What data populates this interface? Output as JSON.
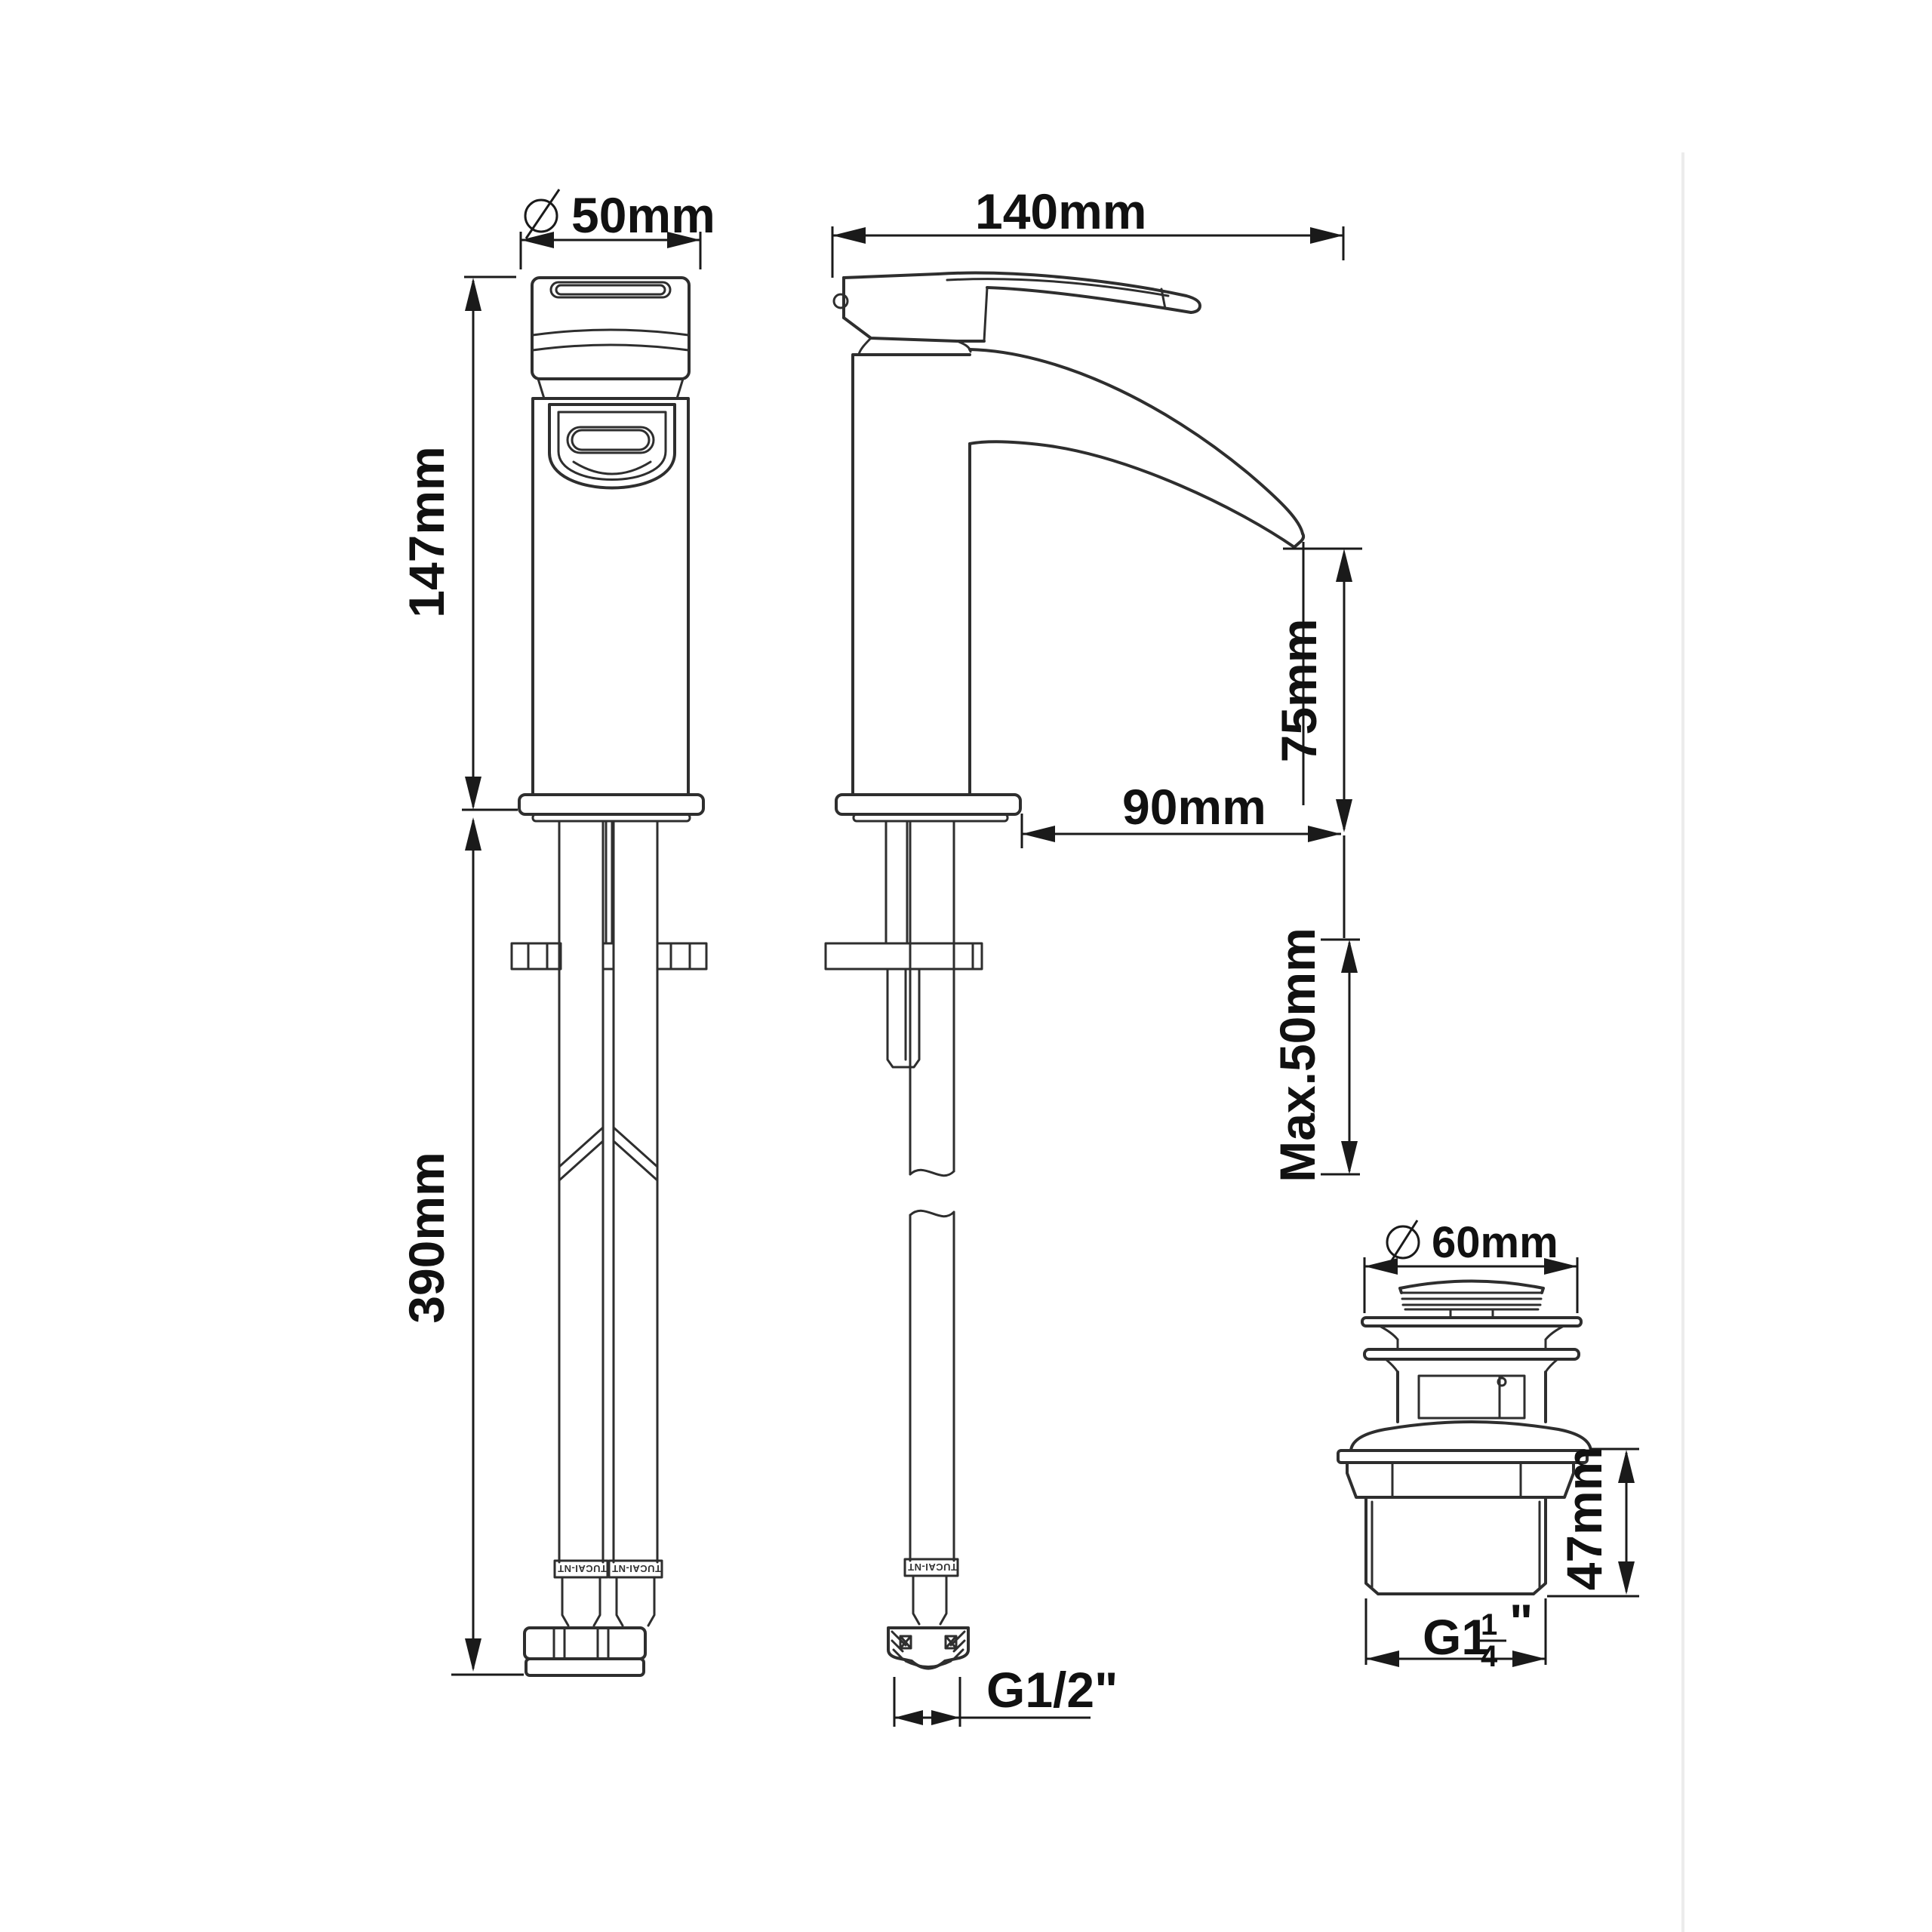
{
  "page": {
    "background": "#ffffff"
  },
  "drawing": {
    "line_color": "#2e2e2e",
    "text_color": "#111111",
    "divider_color": "#ececec"
  },
  "front_view": {
    "diameter_label": "50mm",
    "height_label": "147mm",
    "hose_length_label": "390mm",
    "hose_brand": "TUCAI-NT"
  },
  "side_view": {
    "length_label": "140mm",
    "spout_height_label": "75mm",
    "spout_reach_label": "90mm",
    "max_deck_label": "Max.50mm",
    "hose_thread_label": "G1/2\"",
    "hose_brand": "TUCAI-NT"
  },
  "waste_view": {
    "diameter_label": "60mm",
    "height_label": "47mm",
    "thread_main": "G1",
    "thread_numerator": "1",
    "thread_denominator": "4",
    "thread_quote": "\""
  }
}
